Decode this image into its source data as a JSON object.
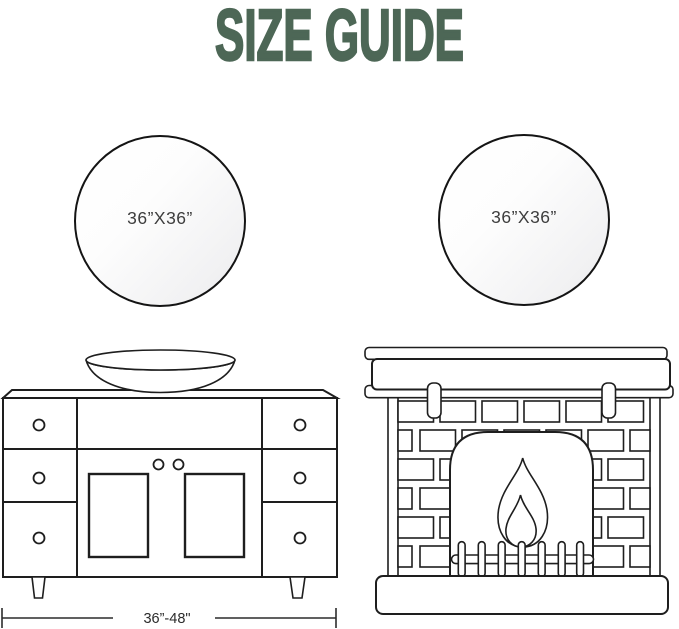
{
  "title": "SIZE GUIDE",
  "colors": {
    "title_green": "#4d6756",
    "line_dark": "#1e1e1e",
    "mirror_border": "#141414",
    "label_gray": "#3d3d3d"
  },
  "mirrors": {
    "left": {
      "label": "36”X36”"
    },
    "right": {
      "label": "36”X36”"
    }
  },
  "vanity": {
    "width_label": "36”-48\""
  },
  "figures": {
    "left": "bathroom-vanity-with-vessel-sink",
    "right": "fireplace"
  }
}
